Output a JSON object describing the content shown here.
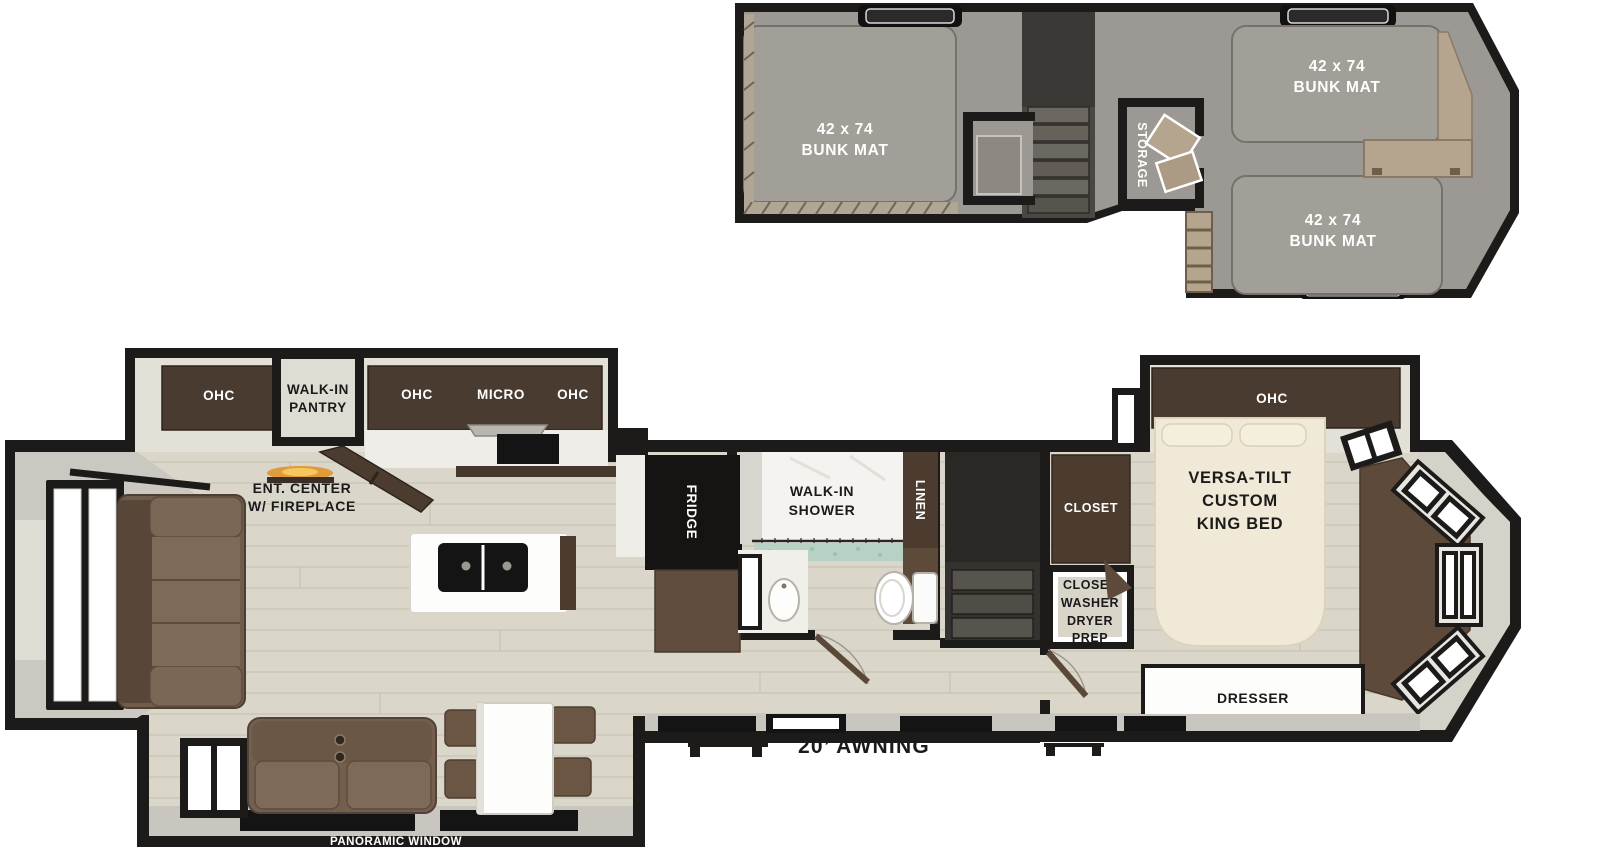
{
  "loft": {
    "bunk_left": {
      "size": "42 x 74",
      "name": "BUNK MAT"
    },
    "bunk_top_right": {
      "size": "42 x 74",
      "name": "BUNK MAT"
    },
    "bunk_bottom_right": {
      "size": "42 x 74",
      "name": "BUNK MAT"
    },
    "storage": "STORAGE"
  },
  "main": {
    "rear_ohc": "OHC",
    "pantry": {
      "line1": "WALK-IN",
      "line2": "PANTRY"
    },
    "kitchen": {
      "ohc_left": "OHC",
      "micro": "MICRO",
      "ohc_right": "OHC",
      "fridge": "FRIDGE"
    },
    "ent_center": {
      "line1": "ENT. CENTER",
      "line2": "W/ FIREPLACE"
    },
    "bath": {
      "shower_line1": "WALK-IN",
      "shower_line2": "SHOWER",
      "linen": "LINEN"
    },
    "bedroom": {
      "ohc": "OHC",
      "bed_line1": "VERSA-TILT",
      "bed_line2": "CUSTOM",
      "bed_line3": "KING BED",
      "closet": "CLOSET",
      "wd_line1": "CLOSET",
      "wd_line2": "WASHER",
      "wd_line3": "DRYER",
      "wd_line4": "PREP",
      "dresser": "DRESSER"
    },
    "panoramic_window": "PANORAMIC WINDOW",
    "awning": "20’ AWNING"
  },
  "colors": {
    "wall": "#1d1b19",
    "carpet": "#9c9893",
    "bunk_mat": "#a29e98",
    "floor": "#dad6ca",
    "plank_line": "#c7c3b5",
    "dark_wood_cabinet": "#4a3b30",
    "mid_wood": "#5d4a3a",
    "tan_wood": "#b5a48e",
    "sofa_brown": "#745f4d",
    "mattress_cream": "#f0e9d7",
    "shower_tile_teal": "#b7d2c5",
    "interior_band": "#e3e0d8",
    "sill_gray": "#c9c6bf",
    "fireplace_orange": "#e09b3a"
  }
}
